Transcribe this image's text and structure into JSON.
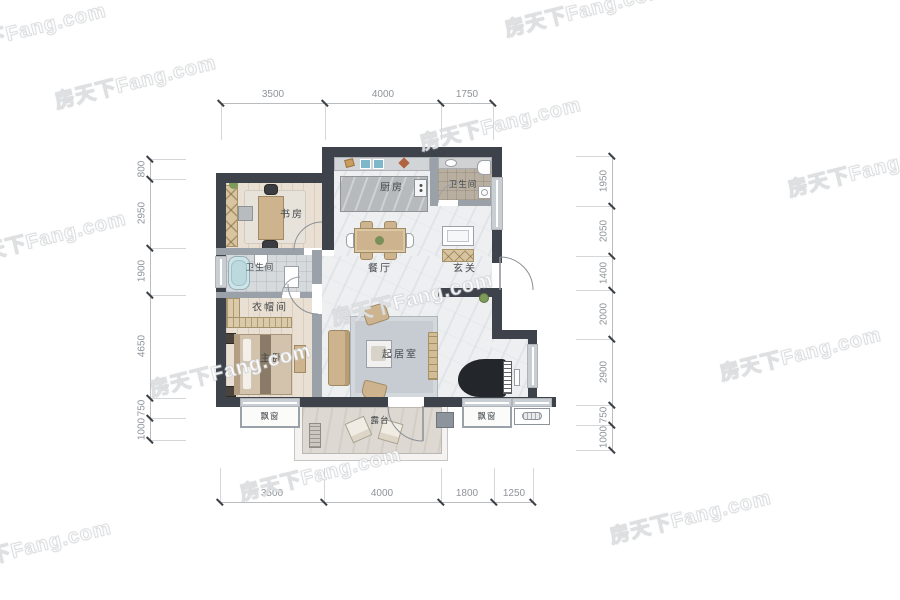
{
  "watermark": {
    "text": "房天下Fang.com"
  },
  "plan": {
    "rooms": {
      "study": "书房",
      "kitchen": "厨房",
      "bath_top": "卫生间",
      "dining": "餐厅",
      "entry": "玄关",
      "bath_left": "卫生间",
      "cloakroom": "衣帽间",
      "master": "主卧",
      "living": "起居室",
      "bay_left": "飘窗",
      "terrace": "露台",
      "bay_right": "飘窗"
    }
  },
  "dimensions": {
    "top": [
      {
        "label": "3500"
      },
      {
        "label": "4000"
      },
      {
        "label": "1750"
      }
    ],
    "bottom": [
      {
        "label": "3500"
      },
      {
        "label": "4000"
      },
      {
        "label": "1800"
      },
      {
        "label": "1250"
      }
    ],
    "left": [
      {
        "label": "800"
      },
      {
        "label": "2950"
      },
      {
        "label": "1900"
      },
      {
        "label": "4650"
      },
      {
        "label": "750"
      },
      {
        "label": "1000"
      }
    ],
    "right": [
      {
        "label": "1950"
      },
      {
        "label": "2050"
      },
      {
        "label": "1400"
      },
      {
        "label": "2000"
      },
      {
        "label": "2900"
      },
      {
        "label": "750"
      },
      {
        "label": "1000"
      }
    ]
  },
  "colors": {
    "wall_dark": "#3e434b",
    "wall_interior": "#9aa1a8",
    "wood_accent": "#d8c49e",
    "tub_blue": "#cfe4e8",
    "sink_blue": "#7db7c9",
    "marble": "#edeff1"
  }
}
